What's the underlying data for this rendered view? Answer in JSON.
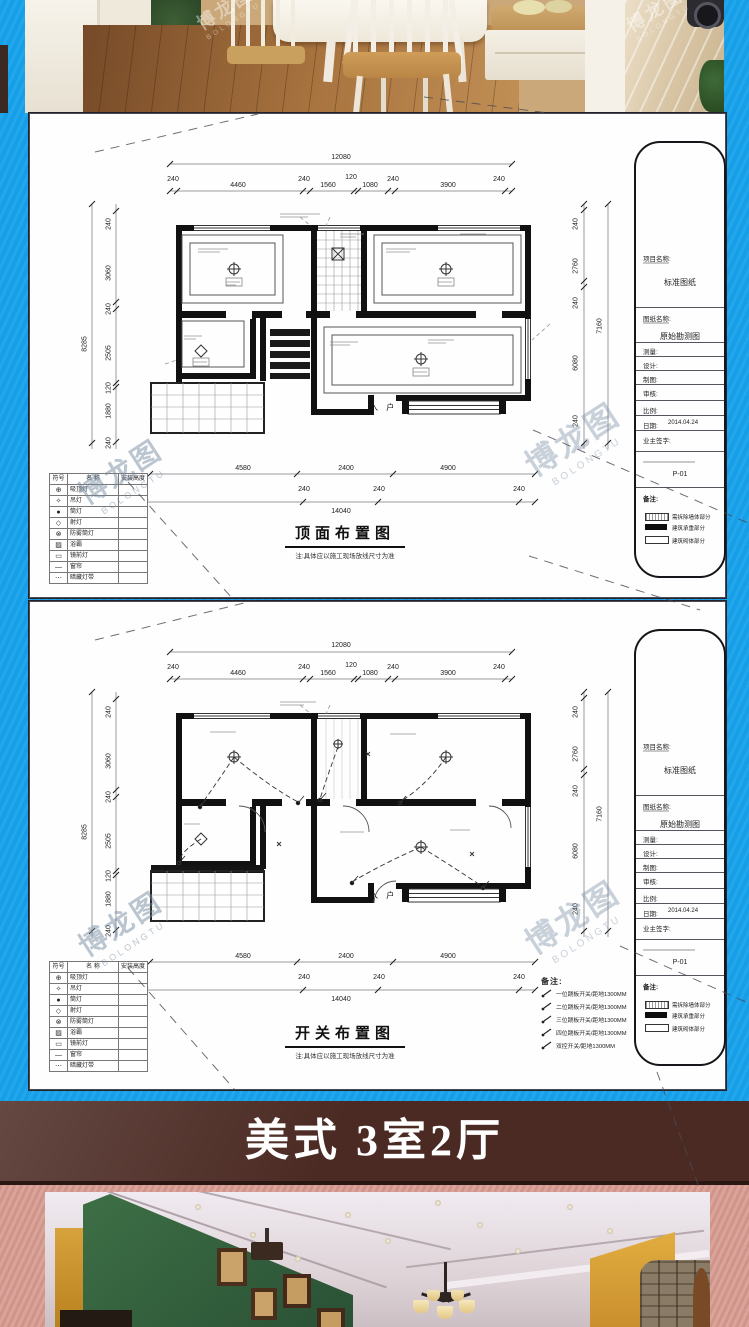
{
  "watermark": {
    "cn": "博龙图",
    "en": "BOLONGTU"
  },
  "banner": {
    "title": "美式 3室2厅",
    "bg_color": "#4b2a23",
    "text_color": "#ffffff"
  },
  "page_colors": {
    "blue_bg": "#149fe8",
    "pink_bg": "#dba49a"
  },
  "plan_common": {
    "entrance": "入 户",
    "dims": {
      "top_total": "12080",
      "top_segments": [
        "240",
        "4460",
        "240",
        "1560",
        "120",
        "1080",
        "240",
        "3900",
        "240"
      ],
      "bottom_spans": [
        "4580",
        "2400",
        "4900"
      ],
      "bottom_minor": [
        "240",
        "240",
        "240"
      ],
      "bottom_total": "14040",
      "left_outer": "8285",
      "left_segments": [
        "240",
        "3060",
        "240",
        "2505",
        "120",
        "1880",
        "240"
      ],
      "right_outer": "7160",
      "right_segments": [
        "240",
        "2760",
        "240",
        "6080",
        "240"
      ]
    },
    "legend_table": {
      "headers": [
        "符号",
        "名 称",
        "安装高度"
      ],
      "rows": [
        {
          "symbol": "⊕",
          "name": "吸顶灯"
        },
        {
          "symbol": "✧",
          "name": "吊灯"
        },
        {
          "symbol": "●",
          "name": "筒灯"
        },
        {
          "symbol": "◇",
          "name": "射灯"
        },
        {
          "symbol": "⊗",
          "name": "防雾筒灯"
        },
        {
          "symbol": "▨",
          "name": "浴霸"
        },
        {
          "symbol": "▭",
          "name": "镜前灯"
        },
        {
          "symbol": "—",
          "name": "窗帘"
        },
        {
          "symbol": "⋯",
          "name": "暗藏灯带"
        }
      ]
    },
    "title_block": {
      "project_label": "项目名称:",
      "project_value": "标准图纸",
      "drawing_label": "图纸名称:",
      "drawing_value": "原始勘测图",
      "fields": [
        {
          "label": "测量:",
          "value": ""
        },
        {
          "label": "设计:",
          "value": ""
        },
        {
          "label": "制图:",
          "value": ""
        },
        {
          "label": "审核:",
          "value": ""
        },
        {
          "label": "比例:",
          "value": ""
        },
        {
          "label": "日期:",
          "value": "2014.04.24"
        },
        {
          "label": "业主签字:",
          "value": ""
        }
      ],
      "drawing_no": "P-01",
      "remarks_label": "备注:",
      "legend": [
        {
          "style": "hatch",
          "label": "需拆除墙体部分"
        },
        {
          "style": "solid",
          "label": "建筑承重部分"
        },
        {
          "style": "outline",
          "label": "建筑砌体部分"
        }
      ]
    }
  },
  "panel1": {
    "title": "顶面布置图",
    "note": "注:具体应以施工现场放线尺寸为准"
  },
  "panel2": {
    "title": "开关布置图",
    "note": "注:具体应以施工现场放线尺寸为准",
    "remarks_label": "备注:",
    "switch_notes": [
      "一位跷板开关/距地1300MM",
      "二位跷板开关/距地1300MM",
      "三位跷板开关/距地1300MM",
      "四位跷板开关/距地1300MM",
      "双控开关/距地1300MM"
    ]
  }
}
